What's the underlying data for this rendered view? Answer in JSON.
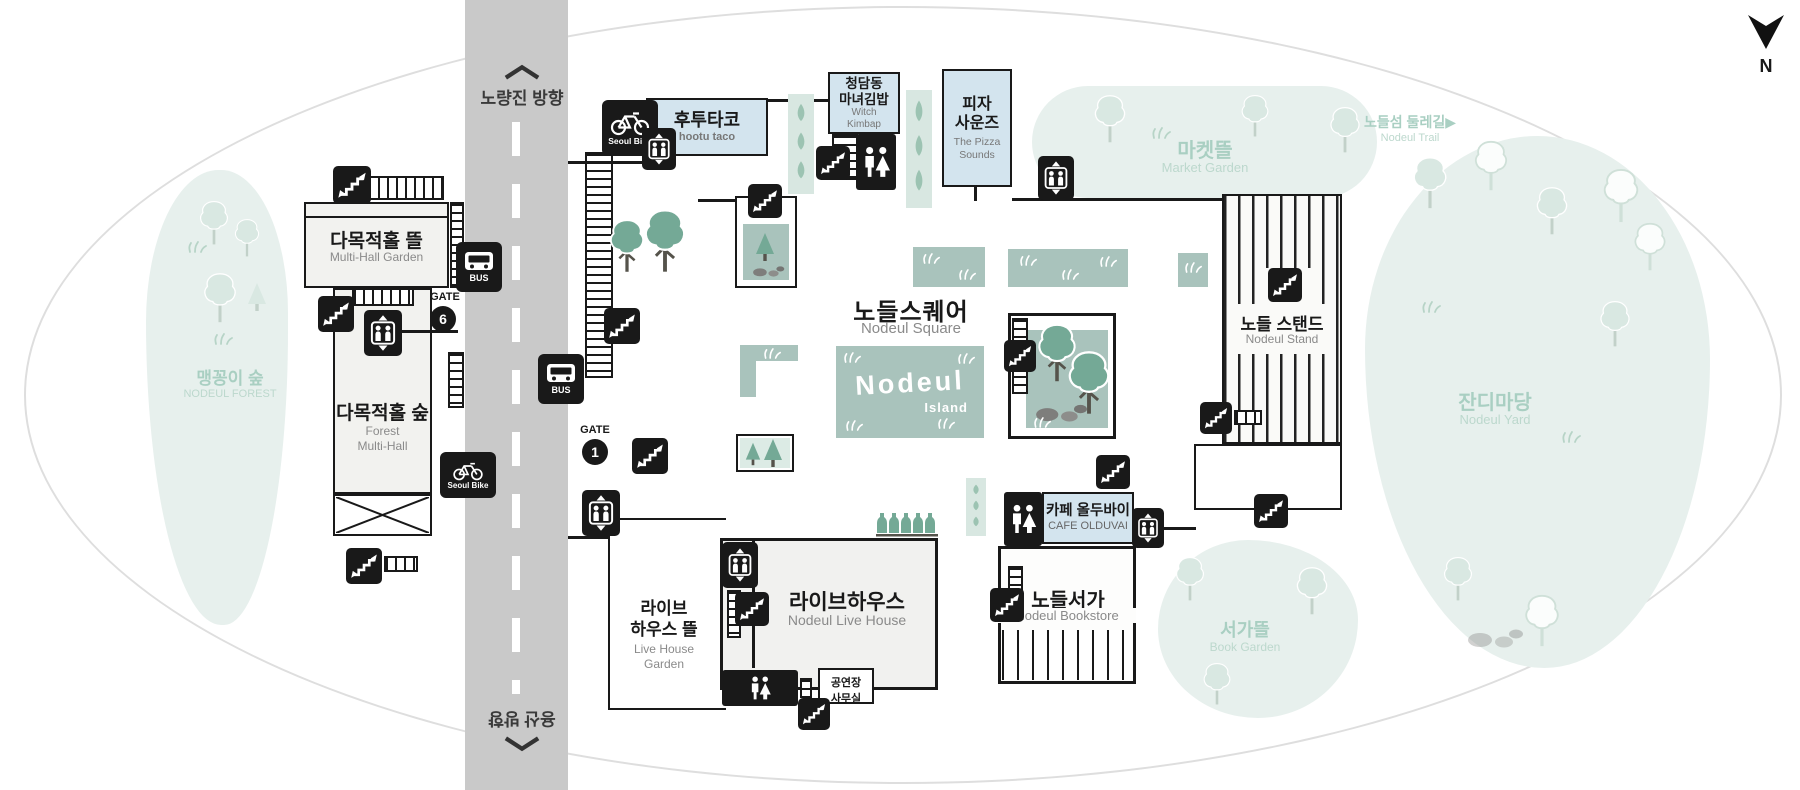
{
  "map": {
    "compass_label": "N",
    "road": {
      "top_direction": "노량진 방향",
      "bottom_direction": "용산 방향"
    },
    "gates": [
      {
        "label": "GATE",
        "number": "6"
      },
      {
        "label": "GATE",
        "number": "1"
      }
    ],
    "transport": {
      "bus_label": "BUS",
      "bike_label": "Seoul Bike"
    },
    "places": {
      "nodeul_forest": {
        "ko": "맹꽁이 숲",
        "en": "NODEUL FOREST"
      },
      "multi_hall_garden": {
        "ko": "다목적홀 뜰",
        "en": "Multi-Hall Garden"
      },
      "forest_multi_hall": {
        "ko": "다목적홀 숲",
        "en_line1": "Forest",
        "en_line2": "Multi-Hall"
      },
      "hootu_taco": {
        "ko": "후투타코",
        "en": "hootu taco"
      },
      "witch_kimbap": {
        "ko_line1": "청담동",
        "ko_line2": "마녀김밥",
        "en_line1": "Witch",
        "en_line2": "Kimbap"
      },
      "pizza_sounds": {
        "ko_line1": "피자",
        "ko_line2": "사운즈",
        "en_line1": "The Pizza",
        "en_line2": "Sounds"
      },
      "market_garden": {
        "ko": "마켓뜰",
        "en": "Market Garden"
      },
      "nodeul_trail": {
        "ko": "노들섬 둘레길▶",
        "en": "Nodeul Trail"
      },
      "nodeul_square": {
        "ko": "노들스퀘어",
        "en": "Nodeul Square"
      },
      "island_logo": {
        "line1": "Nodeul",
        "line2": "Island"
      },
      "nodeul_stand": {
        "ko": "노들 스탠드",
        "en": "Nodeul Stand"
      },
      "nodeul_yard": {
        "ko": "잔디마당",
        "en": "Nodeul Yard"
      },
      "cafe_olduvai": {
        "ko": "카페 올두바이",
        "en": "CAFE OLDUVAI"
      },
      "nodeul_bookstore": {
        "ko": "노들서가",
        "en": "Nodeul Bookstore"
      },
      "book_garden": {
        "ko": "서가뜰",
        "en": "Book Garden"
      },
      "live_house": {
        "ko": "라이브하우스",
        "en": "Nodeul Live House"
      },
      "live_house_garden": {
        "ko_line1": "라이브",
        "ko_line2": "하우스 뜰",
        "en_line1": "Live House",
        "en_line2": "Garden"
      },
      "venue_office": {
        "ko_line1": "공연장",
        "ko_line2": "사무실"
      }
    },
    "icon_names": [
      "stairs-icon",
      "elevator-icon",
      "restroom-icon",
      "bus-stop-icon",
      "seoul-bike-icon",
      "compass-north-icon"
    ],
    "colors": {
      "food_blue": "#d3e4ee",
      "sage_green": "#a9c3bc",
      "mint_area": "#e7f0ed",
      "mint_text": "#a9cfc2",
      "icon_black": "#191919",
      "road_gray": "#c9c9c9",
      "tree_green": "#74a996"
    }
  }
}
